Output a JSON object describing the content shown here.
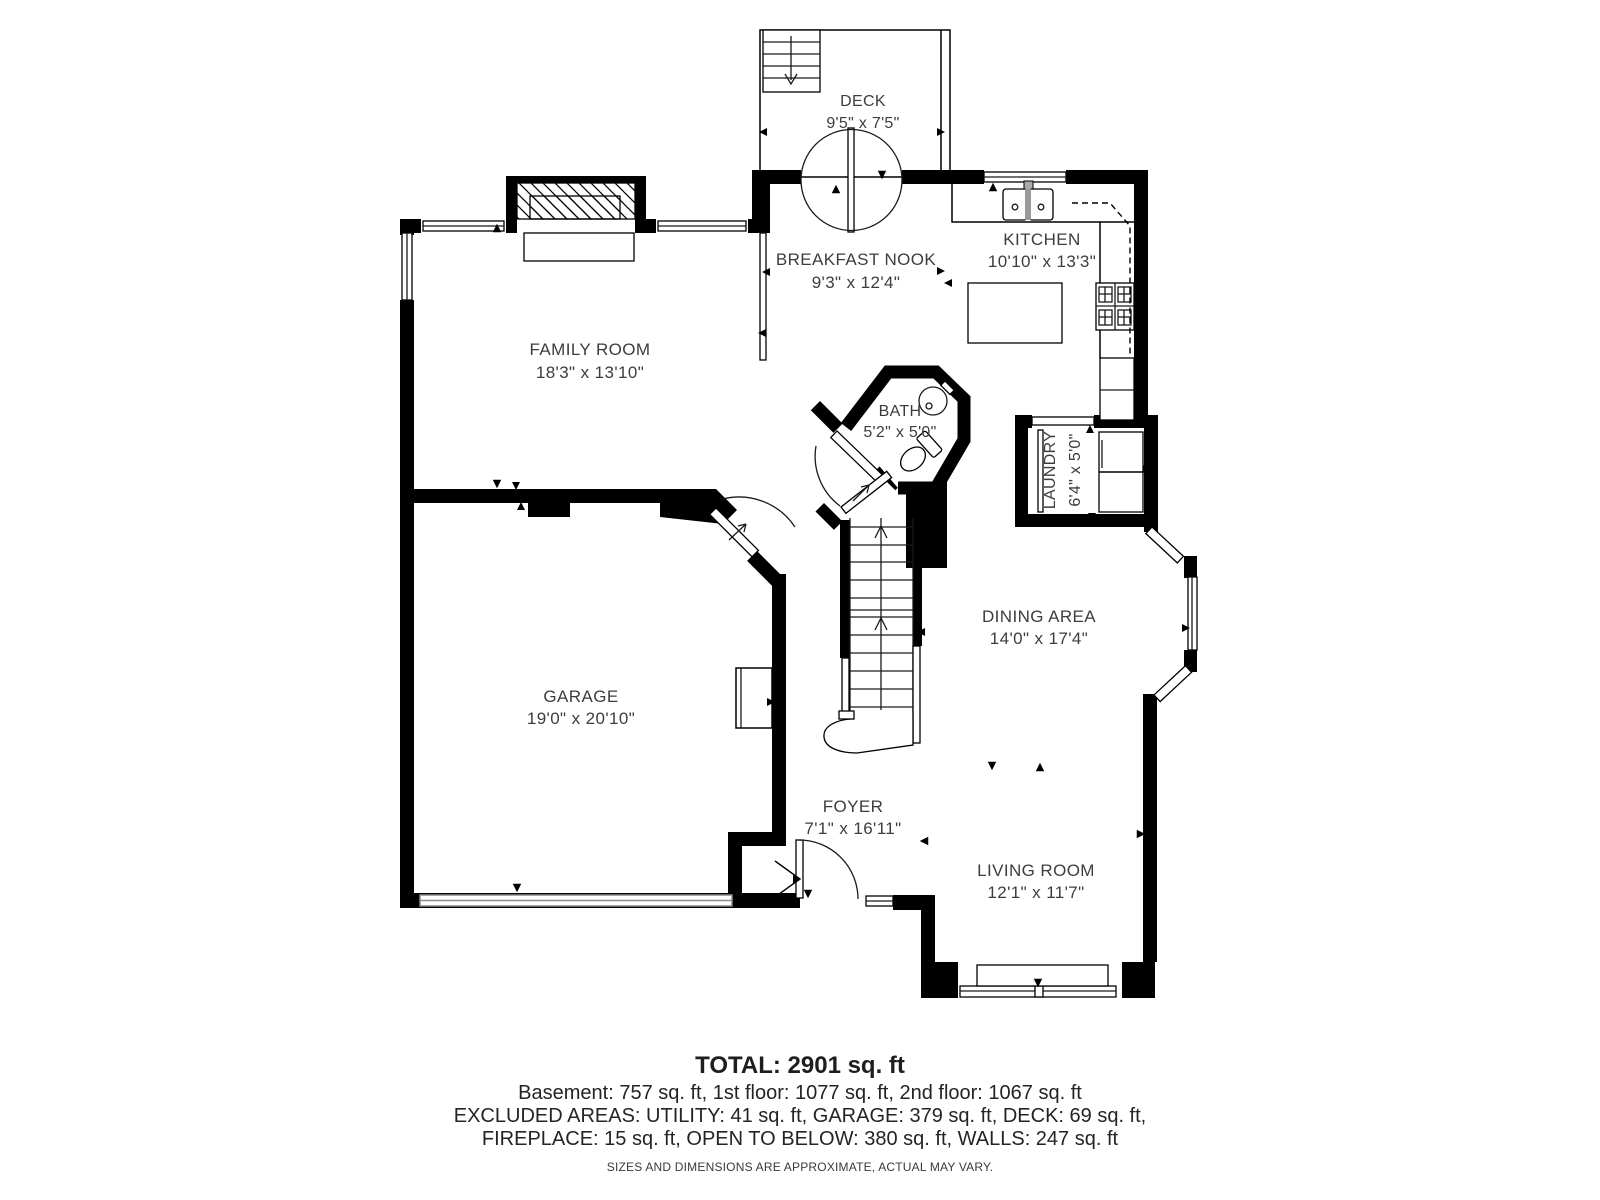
{
  "colors": {
    "wall": "#000000",
    "text": "#3d3d3d",
    "background": "#ffffff"
  },
  "rooms": {
    "deck": {
      "name": "DECK",
      "dims": "9'5\" x 7'5\""
    },
    "breakfast_nook": {
      "name": "BREAKFAST NOOK",
      "dims": "9'3\" x 12'4\""
    },
    "kitchen": {
      "name": "KITCHEN",
      "dims": "10'10\" x 13'3\""
    },
    "family_room": {
      "name": "FAMILY ROOM",
      "dims": "18'3\" x 13'10\""
    },
    "bath": {
      "name": "BATH",
      "dims": "5'2\" x 5'0\""
    },
    "laundry": {
      "name": "LAUNDRY",
      "dims": "6'4\" x 5'0\""
    },
    "garage": {
      "name": "GARAGE",
      "dims": "19'0\" x 20'10\""
    },
    "dining_area": {
      "name": "DINING AREA",
      "dims": "14'0\" x 17'4\""
    },
    "foyer": {
      "name": "FOYER",
      "dims": "7'1\" x 16'11\""
    },
    "living_room": {
      "name": "LIVING ROOM",
      "dims": "12'1\" x 11'7\""
    }
  },
  "summary": {
    "total": "TOTAL: 2901 sq. ft",
    "floors": "Basement: 757 sq. ft, 1st floor: 1077 sq. ft, 2nd floor: 1067 sq. ft",
    "excluded_line1": "EXCLUDED AREAS: UTILITY: 41 sq. ft, GARAGE: 379 sq. ft, DECK: 69 sq. ft,",
    "excluded_line2": "FIREPLACE: 15 sq. ft, OPEN TO BELOW: 380 sq. ft, WALLS: 247 sq. ft",
    "disclaimer": "SIZES AND DIMENSIONS ARE APPROXIMATE, ACTUAL MAY VARY."
  }
}
